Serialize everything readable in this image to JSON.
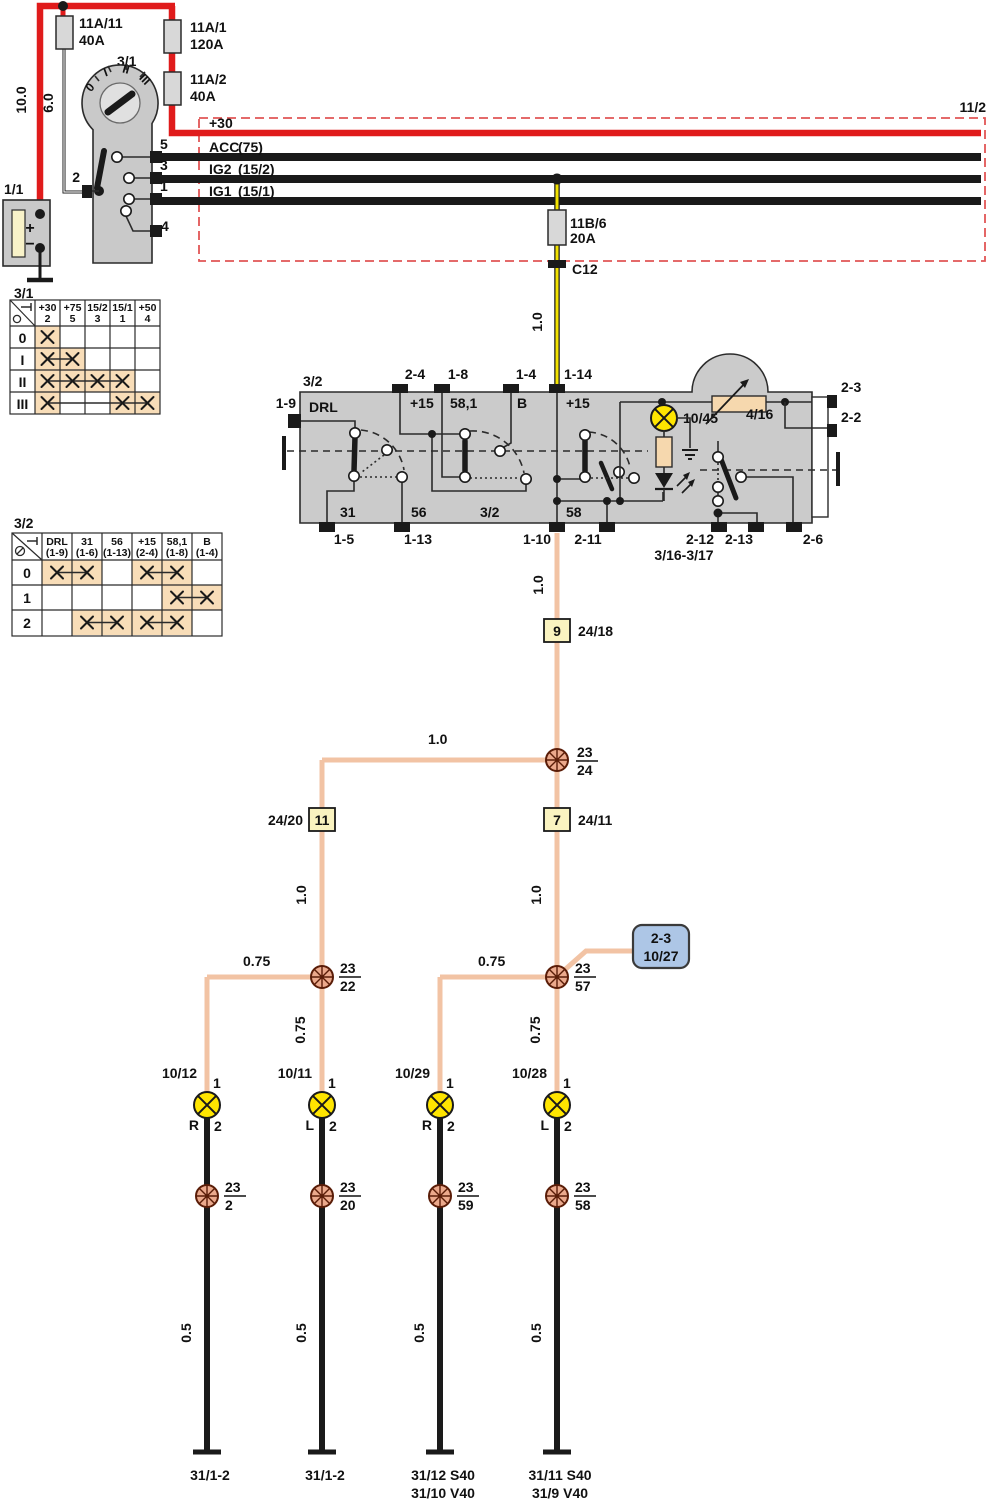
{
  "sheet": {
    "ref": "11/2"
  },
  "colors": {
    "wire_red": "#e01b1b",
    "wire_yellow": "#f2e200",
    "wire_salmon": "#f2c3a4",
    "lamp_yellow": "#ffe500",
    "table_highlight": "#f8ddb8",
    "remote_box_blue": "#adc6e6",
    "module_gray": "#cbcbcb",
    "dashed_box_red": "#e15555"
  },
  "battery": {
    "id": "1/1",
    "plus": "+",
    "minus": "−",
    "wire": "10.0"
  },
  "ignition": {
    "id": "3/1",
    "wire": "6.0",
    "positions": [
      "0",
      "I",
      "II",
      "III"
    ],
    "pin2": "2",
    "pin5": "5",
    "pin3": "3",
    "pin1": "1",
    "pin4": "4"
  },
  "fuse_a11": {
    "name": "11A/11",
    "rating": "40A"
  },
  "fuse_a1": {
    "name": "11A/1",
    "rating": "120A"
  },
  "fuse_a2": {
    "name": "11A/2",
    "rating": "40A"
  },
  "fuse_b6": {
    "name": "11B/6",
    "rating": "20A"
  },
  "c12": "C12",
  "bus": {
    "p30": "+30",
    "acc": "ACC",
    "acc_alt": "(75)",
    "ig2": "IG2",
    "ig2_alt": "(15/2)",
    "ig1": "IG1",
    "ig1_alt": "(15/1)",
    "fuse_wire": "1.0"
  },
  "table31": {
    "title": "3/1",
    "col_top": [
      "+30",
      "+75",
      "15/2",
      "15/1",
      "+50"
    ],
    "col_bot": [
      "2",
      "5",
      "3",
      "1",
      "4"
    ],
    "rows": [
      "0",
      "I",
      "II",
      "III"
    ],
    "marks": [
      [
        0
      ],
      [
        0,
        1
      ],
      [
        0,
        1,
        2,
        3
      ],
      [
        0,
        3,
        4
      ]
    ]
  },
  "table32": {
    "title": "3/2",
    "col_top": [
      "DRL",
      "31",
      "56",
      "+15",
      "58,1",
      "B"
    ],
    "col_bot": [
      "(1-9)",
      "(1-6)",
      "(1-13)",
      "(2-4)",
      "(1-8)",
      "(1-4)"
    ],
    "rows": [
      "0",
      "1",
      "2"
    ],
    "marks": [
      [
        [
          0,
          1
        ],
        [
          3,
          4
        ]
      ],
      [
        [
          4,
          5
        ]
      ],
      [
        [
          1,
          2
        ],
        [
          3,
          4
        ]
      ]
    ]
  },
  "module": {
    "id": "3/2",
    "pin_1_9": "1-9",
    "pin_2_4": "2-4",
    "pin_1_8": "1-8",
    "pin_1_4": "1-4",
    "pin_1_14": "1-14",
    "lbl_drl": "DRL",
    "lbl_15a": "+15",
    "lbl_581": "58,1",
    "lbl_b": "B",
    "lbl_15b": "+15",
    "lbl_31": "31",
    "lbl_56": "56",
    "lbl_32": "3/2",
    "lbl_58": "58",
    "pin_1_5": "1-5",
    "pin_1_13": "1-13",
    "pin_1_10": "1-10",
    "pin_2_11": "2-11",
    "pin_2_12": "2-12",
    "pin_2_13": "2-13",
    "pin_2_6": "2-6",
    "ref_ground": "3/16-3/17",
    "pin_2_3": "2-3",
    "pin_2_2": "2-2",
    "lamp": "10/45",
    "rheostat": "4/16"
  },
  "dist": {
    "w_down": "1.0",
    "conn9_num": "9",
    "conn9_ref": "24/18",
    "w_horiz": "1.0",
    "conn11_num": "11",
    "conn11_ref": "24/20",
    "conn7_num": "7",
    "conn7_ref": "24/11",
    "sp2324_t": "23",
    "sp2324_b": "24",
    "sp2322_t": "23",
    "sp2322_b": "22",
    "sp2357_t": "23",
    "sp2357_b": "57",
    "w_left": "1.0",
    "w_right": "1.0",
    "w075_l": "0.75",
    "w075_lv": "0.75",
    "w075_r": "0.75",
    "w075_rv": "0.75",
    "remote_ref": "2-3",
    "remote_id": "10/27"
  },
  "lamps": [
    {
      "id": "10/12",
      "pin1": "1",
      "side": "R",
      "pin2": "2",
      "sp_t": "23",
      "sp_b": "2",
      "wire": "0.5",
      "gnd1": "31/1-2",
      "gnd2": ""
    },
    {
      "id": "10/11",
      "pin1": "1",
      "side": "L",
      "pin2": "2",
      "sp_t": "23",
      "sp_b": "20",
      "wire": "0.5",
      "gnd1": "31/1-2",
      "gnd2": ""
    },
    {
      "id": "10/29",
      "pin1": "1",
      "side": "R",
      "pin2": "2",
      "sp_t": "23",
      "sp_b": "59",
      "wire": "0.5",
      "gnd1": "31/12 S40",
      "gnd2": "31/10 V40"
    },
    {
      "id": "10/28",
      "pin1": "1",
      "side": "L",
      "pin2": "2",
      "sp_t": "23",
      "sp_b": "58",
      "wire": "0.5",
      "gnd1": "31/11 S40",
      "gnd2": "31/9 V40"
    }
  ]
}
